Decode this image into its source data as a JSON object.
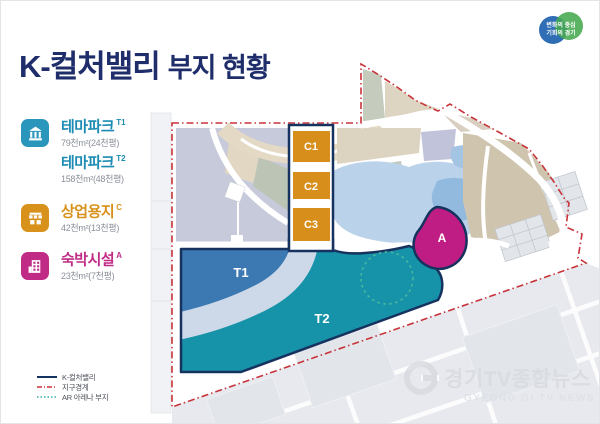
{
  "header": {
    "title_main": "K-컬처밸리",
    "title_sub": "부지 현황"
  },
  "logo": {
    "line1": "변화의 중심",
    "line2": "기회의 경기"
  },
  "legend": {
    "items": [
      {
        "icon": "theme-park",
        "label": "테마파크",
        "code": "T1",
        "area": "79천m²(24천평)",
        "color": "#1d8cb4"
      },
      {
        "icon": "none",
        "label": "테마파크",
        "code": "T2",
        "area": "158천m²(48천평)",
        "color": "#1d8cb4"
      },
      {
        "icon": "shop",
        "label": "상업용지",
        "code": "C",
        "area": "42천m²(13천평)",
        "color": "#d8921c"
      },
      {
        "icon": "hotel",
        "label": "숙박시설",
        "code": "A",
        "area": "23천m²(7천평)",
        "color": "#c02c85"
      }
    ]
  },
  "map": {
    "zones": {
      "c1": "C1",
      "c2": "C2",
      "c3": "C3",
      "t1": "T1",
      "t2": "T2",
      "a": "A"
    },
    "legend": [
      {
        "label": "K-컬처밸리",
        "style": "solid",
        "color": "#16325f"
      },
      {
        "label": "지구경계",
        "style": "dashdot",
        "color": "#c8333a"
      },
      {
        "label": "AR 아레나 부지",
        "style": "dotted",
        "color": "#35b4a8"
      }
    ]
  },
  "watermark": {
    "korean": "경기TV종합뉴스",
    "english": "GYEONG GI TV NEWS"
  },
  "colors": {
    "title_navy": "#1f2e6b",
    "zone_outline": "#16325f",
    "theme_park_fill_t1": "#3c78b2",
    "theme_park_fill_t2": "#1793a9",
    "commercial_fill": "#d78e1a",
    "lodging_fill": "#c01d84",
    "boundary_red": "#c8333a",
    "arena_dot_teal": "#49b8a0",
    "river_band": "#cdd9e9",
    "lake_blue": "#bad2ea"
  }
}
